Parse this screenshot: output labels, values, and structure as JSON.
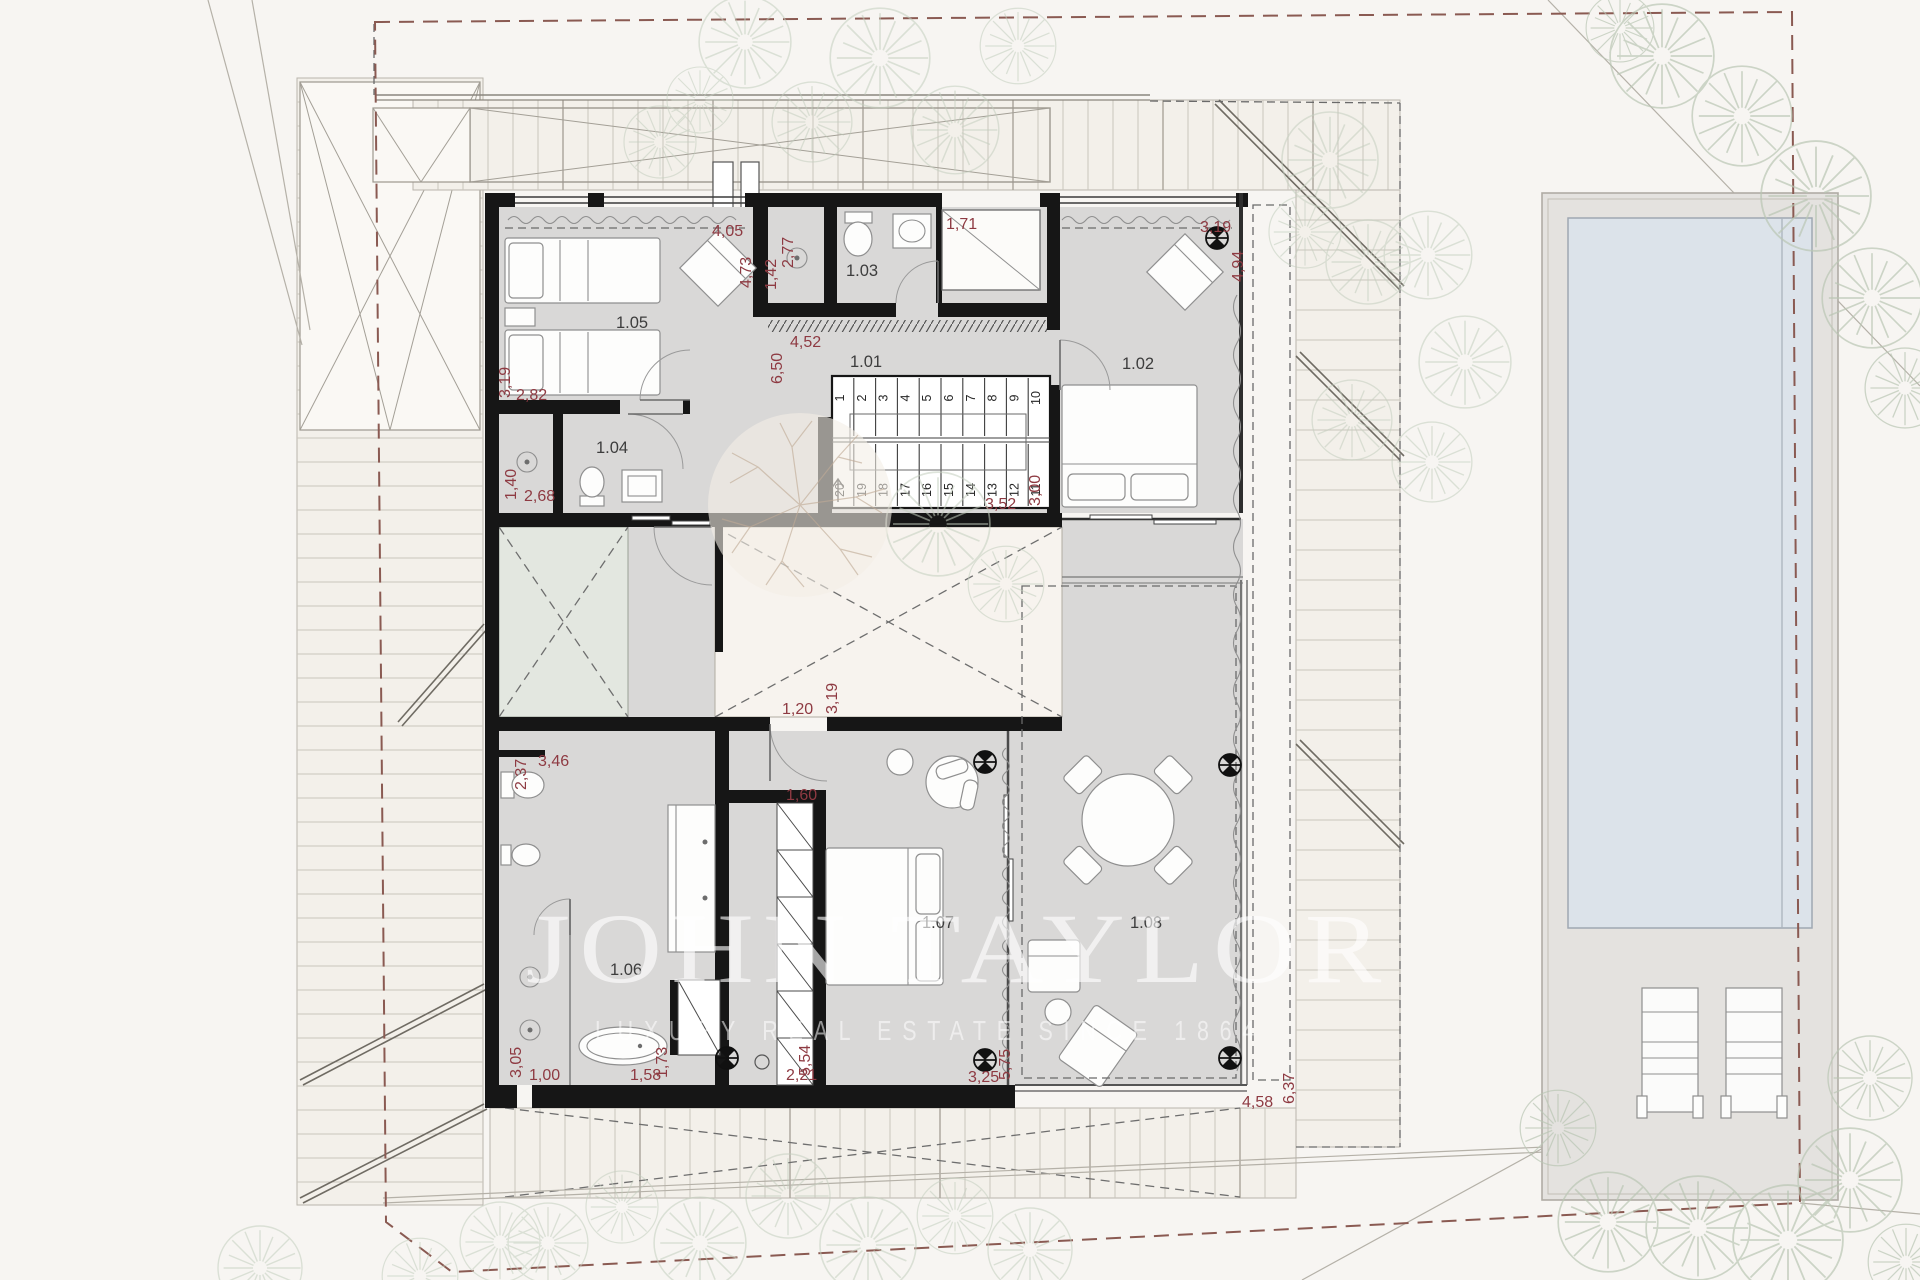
{
  "watermark": {
    "brand": "JOHN TAYLOR",
    "tagline": "LUXURY REAL ESTATE SINCE 1864"
  },
  "room_labels": {
    "r101": "1.01",
    "r102": "1.02",
    "r103": "1.03",
    "r104": "1.04",
    "r105": "1.05",
    "r106": "1.06",
    "r107": "1.07",
    "r108": "1.08"
  },
  "dimensions": [
    "4,05",
    "4,73",
    "1,42",
    "2,77",
    "1,71",
    "3,19",
    "4,94",
    "6,50",
    "4,52",
    "3,52",
    "3,00",
    "3,19",
    "2,82",
    "1,40",
    "2,68",
    "1,20",
    "3,19",
    "2,37",
    "3,46",
    "1,60",
    "3,05",
    "1,00",
    "1,58",
    "1,73",
    "2,21",
    "5,54",
    "3,25",
    "5,75",
    "4,58",
    "6,37"
  ],
  "stairs": {
    "up": [
      "1",
      "2",
      "3",
      "4",
      "5",
      "6",
      "7",
      "8",
      "9",
      "10"
    ],
    "down": [
      "20",
      "19",
      "18",
      "17",
      "16",
      "15",
      "14",
      "13",
      "12",
      "11"
    ]
  },
  "colors": {
    "dimension_text": "#8e3a42",
    "wall": "#161616",
    "room_floor": "#d9d8d7",
    "courtyard_green": "#e3e7e0",
    "patio_white": "#f7f3ee",
    "pool_water": "#dce3ea",
    "pool_deck": "#e4e2df",
    "boundary_dash": "#8a5a52",
    "slat_band": "#f3f0ea",
    "watermark": "rgba(255,255,255,0.6)"
  }
}
